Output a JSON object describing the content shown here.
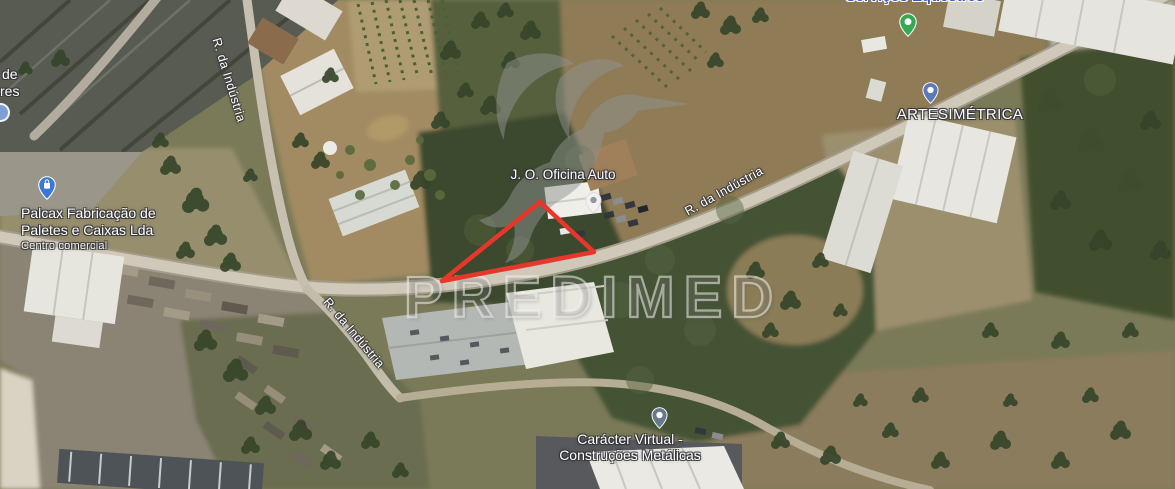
{
  "map_image": {
    "type": "satellite-map-screenshot",
    "watermark": {
      "brand": "PREDIMED",
      "logo": "hummingbird"
    },
    "plot": {
      "outline_color": "#e8372a",
      "shape": "triangle-parcel-outline"
    },
    "road": {
      "name": "R. da Indústria"
    },
    "places": {
      "palcax": {
        "line1": "Palcax Fabricação de",
        "line2": "Paletes e Caixas Lda",
        "subtitle": "Centro comercial",
        "pin_color": "#3a77d6",
        "pin_icon": "shopping-bag"
      },
      "oficina": {
        "name": "J. O. Oficina Auto",
        "pin_color": "#f2f1ef",
        "pin_dot_color": "#9097a1"
      },
      "artesimetrica": {
        "name": "ARTESIMÉTRICA",
        "pin_color": "#5b79b8"
      },
      "caracter": {
        "line1": "Carácter Virtual -",
        "line2": "Construções Metálicas",
        "pin_color": "#68798c"
      },
      "equestres": {
        "name": "Serviços Equestres",
        "pin_color": "#34a853"
      },
      "edge_partial": {
        "line1": "de",
        "line2": "res"
      }
    }
  }
}
